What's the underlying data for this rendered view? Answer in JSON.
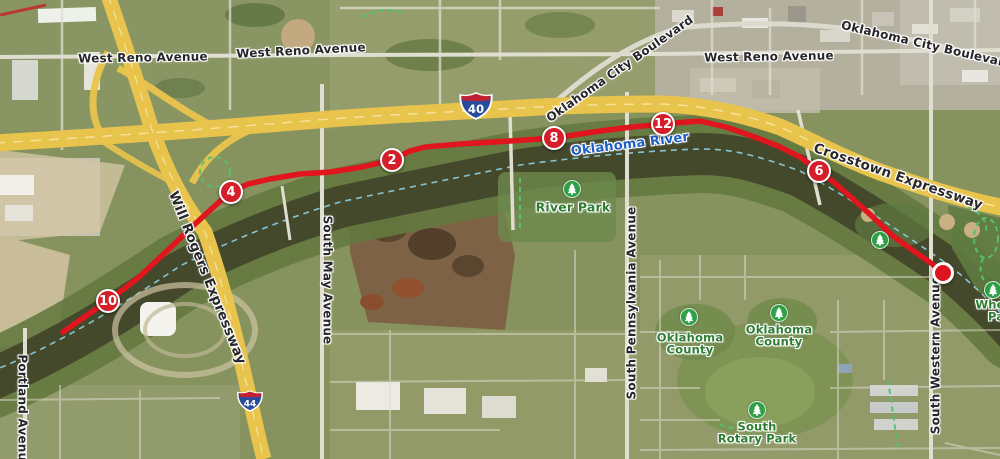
{
  "map": {
    "labels": [
      {
        "text": "West Reno Avenue",
        "x": 143,
        "y": 58,
        "rotate": -1,
        "cls": "street"
      },
      {
        "text": "West Reno Avenue",
        "x": 301,
        "y": 51,
        "rotate": -3,
        "cls": "street"
      },
      {
        "text": "West Reno Avenue",
        "x": 769,
        "y": 57,
        "rotate": -1,
        "cls": "street"
      },
      {
        "text": "Oklahoma City Boulevard",
        "x": 620,
        "y": 69,
        "rotate": -35,
        "cls": "street"
      },
      {
        "text": "Oklahoma City Boulevard",
        "x": 927,
        "y": 45,
        "rotate": 13,
        "cls": "street"
      },
      {
        "text": "Crosstown Expressway",
        "x": 898,
        "y": 177,
        "rotate": 19,
        "cls": "street street-lg"
      },
      {
        "text": "Will Rogers Expressway",
        "x": 207,
        "y": 278,
        "rotate": 68,
        "cls": "street street-lg"
      },
      {
        "text": "South May Avenue",
        "x": 327,
        "y": 280,
        "rotate": 90,
        "cls": "street"
      },
      {
        "text": "South Pennsylvania Avenue",
        "x": 632,
        "y": 303,
        "rotate": -90,
        "cls": "street"
      },
      {
        "text": "South Western Avenue",
        "x": 936,
        "y": 355,
        "rotate": -90,
        "cls": "street"
      },
      {
        "text": "Portland Avenue",
        "x": 22,
        "y": 412,
        "rotate": 90,
        "cls": "street"
      },
      {
        "text": "Oklahoma River",
        "x": 630,
        "y": 145,
        "rotate": -7,
        "cls": "river"
      }
    ],
    "park_labels": [
      {
        "lines": [
          "River Park"
        ],
        "x": 573,
        "y": 207,
        "cls": "park-lg"
      },
      {
        "lines": [
          "Oklahoma",
          "County"
        ],
        "x": 690,
        "y": 344,
        "cls": ""
      },
      {
        "lines": [
          "Oklahoma",
          "County"
        ],
        "x": 779,
        "y": 336,
        "cls": ""
      },
      {
        "lines": [
          "South",
          "Rotary Park"
        ],
        "x": 757,
        "y": 433,
        "cls": ""
      },
      {
        "lines": [
          "Wheeler",
          "Park"
        ],
        "x": 1003,
        "y": 311,
        "cls": ""
      }
    ],
    "tree_icons": [
      {
        "x": 572,
        "y": 189
      },
      {
        "x": 880,
        "y": 240
      },
      {
        "x": 993,
        "y": 290
      },
      {
        "x": 689,
        "y": 317
      },
      {
        "x": 779,
        "y": 313
      },
      {
        "x": 757,
        "y": 410
      }
    ],
    "interstate_shields": [
      {
        "number": "40",
        "x": 476,
        "y": 108,
        "w": 34
      },
      {
        "number": "44",
        "x": 250,
        "y": 403,
        "w": 26
      }
    ],
    "colors": {
      "route_red": "#e0151e",
      "highway_yellow": "#e9c44d",
      "water": "#45492c",
      "river_label_blue": "#1d5fc2",
      "park_green": "#2e7d32",
      "trail_dash_green": "#55c06d",
      "channel_dash_cyan": "#8ed2e6"
    }
  },
  "route": {
    "color": "#e0151e",
    "points": [
      [
        63,
        332
      ],
      [
        80,
        320
      ],
      [
        108,
        301
      ],
      [
        138,
        278
      ],
      [
        168,
        250
      ],
      [
        195,
        224
      ],
      [
        218,
        203
      ],
      [
        231,
        192
      ],
      [
        248,
        184
      ],
      [
        270,
        179
      ],
      [
        300,
        174
      ],
      [
        331,
        172
      ],
      [
        362,
        167
      ],
      [
        392,
        160
      ],
      [
        410,
        151
      ],
      [
        425,
        147
      ],
      [
        460,
        144
      ],
      [
        510,
        141
      ],
      [
        554,
        138
      ],
      [
        600,
        131
      ],
      [
        632,
        127
      ],
      [
        663,
        124
      ],
      [
        700,
        121
      ],
      [
        726,
        127
      ],
      [
        752,
        136
      ],
      [
        778,
        146
      ],
      [
        800,
        157
      ],
      [
        819,
        171
      ],
      [
        836,
        184
      ],
      [
        853,
        199
      ],
      [
        874,
        218
      ],
      [
        893,
        236
      ],
      [
        915,
        252
      ],
      [
        931,
        263
      ],
      [
        943,
        273
      ]
    ],
    "mile_markers": [
      {
        "label": "2",
        "x": 392,
        "y": 160
      },
      {
        "label": "4",
        "x": 231,
        "y": 192
      },
      {
        "label": "6",
        "x": 819,
        "y": 171
      },
      {
        "label": "8",
        "x": 554,
        "y": 138
      },
      {
        "label": "10",
        "x": 108,
        "y": 301
      },
      {
        "label": "12",
        "x": 663,
        "y": 124
      }
    ],
    "end_point": {
      "x": 943,
      "y": 273
    }
  }
}
